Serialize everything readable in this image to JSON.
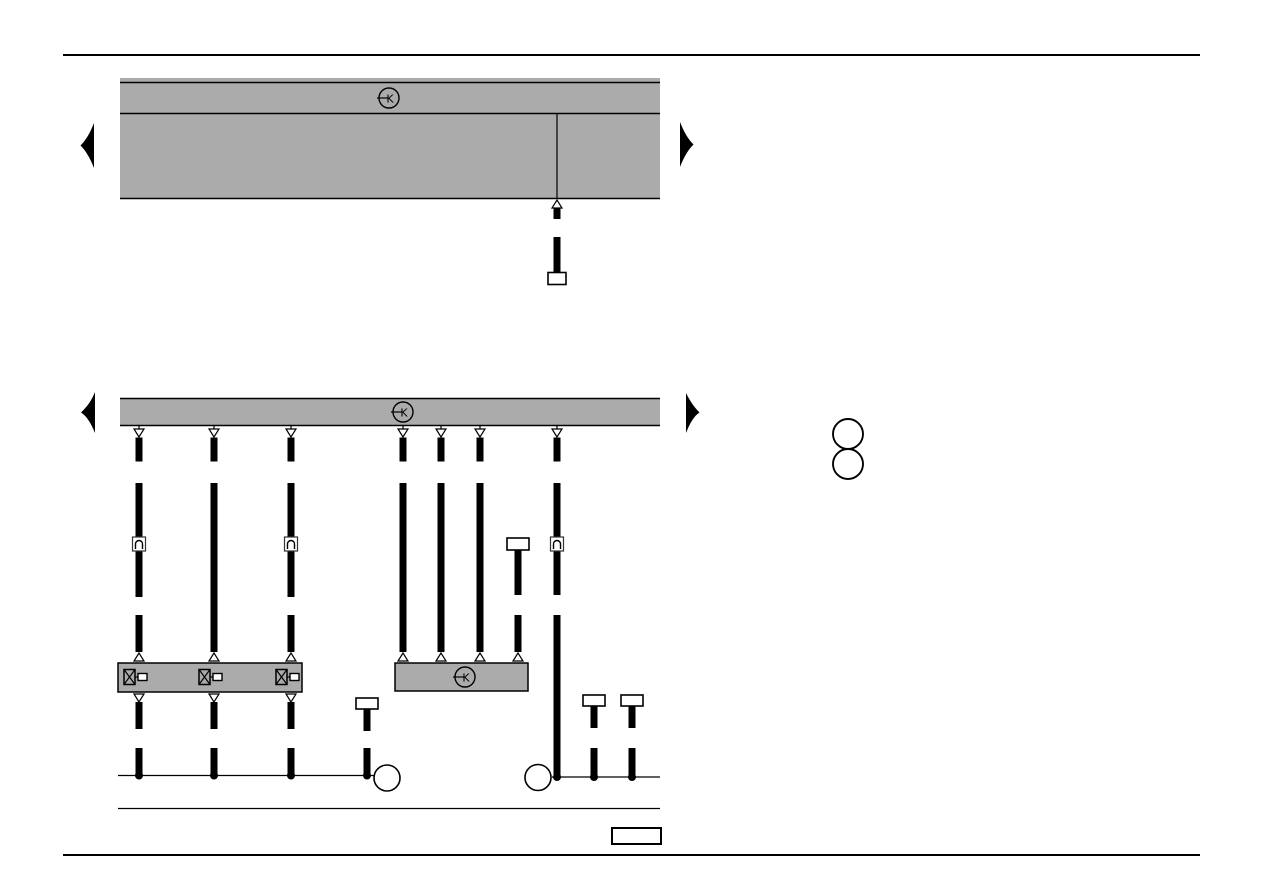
{
  "document": {
    "kind": "automotive current-flow wiring diagram page",
    "background_color": "#ffffff",
    "line_color": "#000000",
    "panel_gray": "#ababab",
    "visible_text": "none except circled K markers"
  },
  "symbols": {
    "k_label": "K",
    "k_icon_meaning": "circled-K harness junction marker",
    "plug_icon_meaning": "inline plug connector",
    "valve_icon_meaning": "valve/solenoid element",
    "continuation_arrow_meaning": "diagram continues on adjacent page"
  },
  "top_section": {
    "panel_name": "upper-harness-panel",
    "k_markers": 1,
    "dropped_wires": 1,
    "wire_end": "open flat connector"
  },
  "main_section": {
    "bus_bar_k_markers": 1,
    "dropped_wires": 8,
    "inline_plug_connectors": 3,
    "component_boxes": 2,
    "component_box_k_markers": 1,
    "valve_elements": 3,
    "flat_connector_stubs": 4,
    "ground_rail_junction_dots": 7,
    "ground_rail_circles": 2
  },
  "callouts": {
    "right_side_empty_circles": 2,
    "bottom_empty_box": 1
  }
}
